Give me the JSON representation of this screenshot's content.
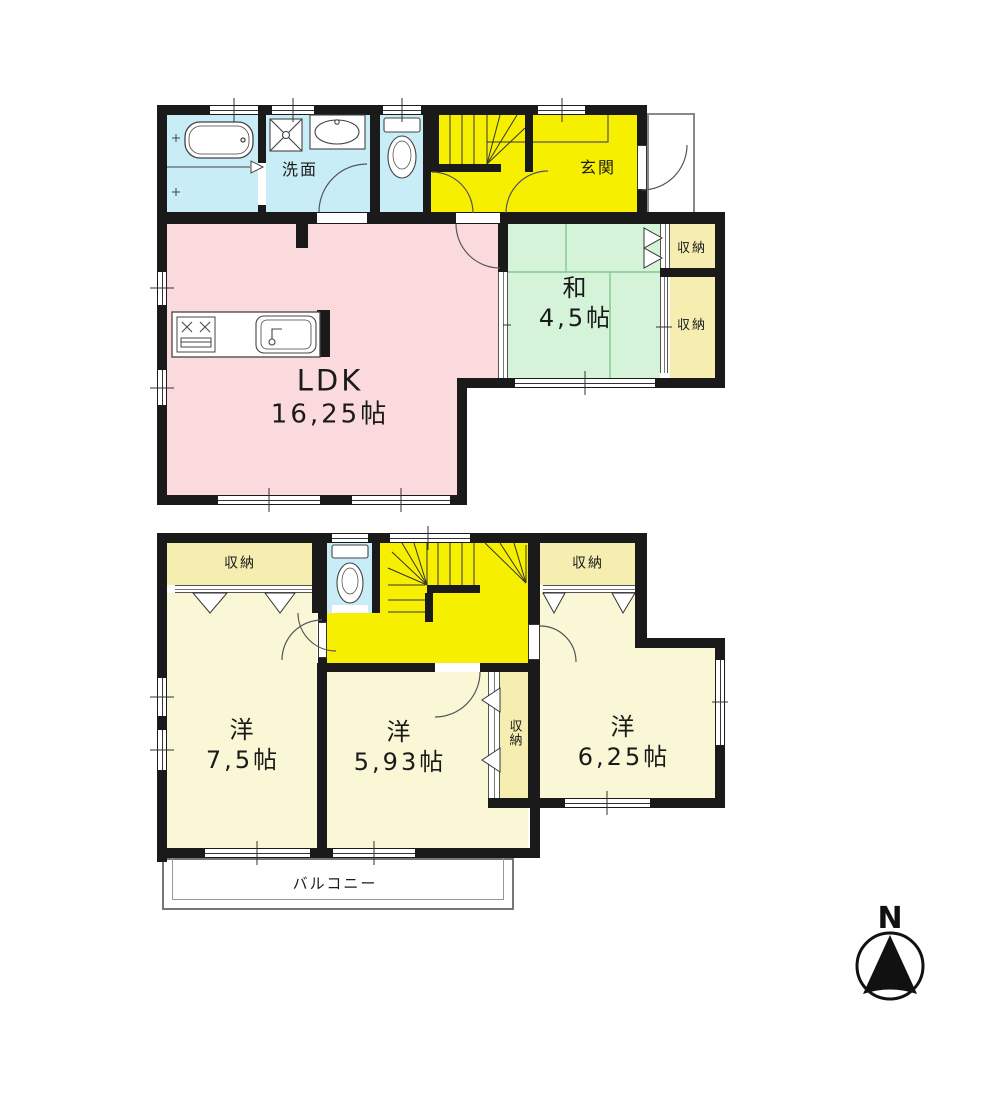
{
  "floor1": {
    "ldk": {
      "label": "LDK",
      "size": "16,25帖"
    },
    "washitsu": {
      "label": "和",
      "size": "4,5帖"
    },
    "genkan": "玄関",
    "senmen": "洗面",
    "storage_upper": "収納",
    "storage_lower": "収納"
  },
  "floor2": {
    "bedroom_left": {
      "label": "洋",
      "size": "7,5帖"
    },
    "bedroom_mid": {
      "label": "洋",
      "size": "5,93帖"
    },
    "bedroom_right": {
      "label": "洋",
      "size": "6,25帖"
    },
    "closet_top_left": "収納",
    "closet_top_right": "収納",
    "closet_mid": "収納",
    "balcony": "バルコニー"
  },
  "compass": {
    "north": "N"
  },
  "colors": {
    "wall": "#1a1a1a",
    "ldk_pink": "#fadadd",
    "washitsu_green": "#d5f3d9",
    "hall_yellow": "#f7ef00",
    "wet_blue": "#c9edf7",
    "bedroom_cream": "#faf7d7",
    "closet_cream": "#f5eeb0"
  }
}
